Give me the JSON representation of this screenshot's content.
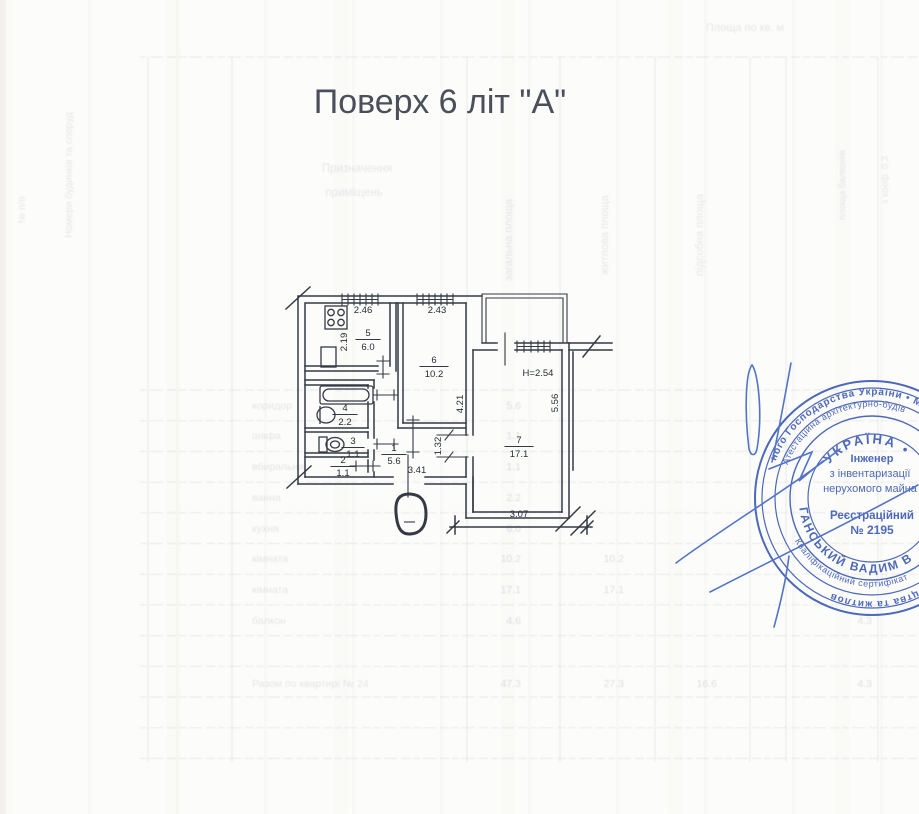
{
  "page": {
    "title": "Поверх 6 літ \"А\""
  },
  "plan": {
    "rooms": [
      {
        "num": "5",
        "area": "6.0"
      },
      {
        "num": "6",
        "area": "10.2"
      },
      {
        "num": "4",
        "area": "2.2"
      },
      {
        "num": "3",
        "area": "1.1"
      },
      {
        "num": "2",
        "area": "1.1"
      },
      {
        "num": "1",
        "area": "5.6"
      },
      {
        "num": "7",
        "area": "17.1"
      }
    ],
    "dims": {
      "w_kitchen": "2.46",
      "w_room6": "2.43",
      "h_kitchen": "2.19",
      "h_room6": "4.21",
      "w_hall": "3.41",
      "w_door7": "1.32",
      "h_room7": "5.56",
      "w_room7": "3.07",
      "ceiling": "Н=2.54"
    },
    "colors": {
      "ink": "#343944"
    }
  },
  "stamp": {
    "outer_top": "ного Господарства України  •  Міністе",
    "outer_bottom": "вництва та житлов",
    "ring2_top": "Атестаційна архітектурно-будів",
    "ring2_bottom": "Кваліфікаційний сертифікат",
    "name_arc": "ГАНСЬКИЙ  ВАДИМ  В",
    "country": "УКРАЇНА •",
    "line1": "Інженер",
    "line2": "з інвентаризації",
    "line3": "нерухомого майна",
    "line4": "Реєстраційний",
    "line5": "№ 2195",
    "color": "#3d5cb5"
  },
  "ghost": {
    "header_top": "Площа по кв. м",
    "purpose_1": "Призначення",
    "purpose_2": "приміщень",
    "vcol_total": "загальна площа",
    "vcol_living": "житлова площа",
    "vcol_aux": "підсобна площа",
    "vcol_balc": "площа балконів",
    "vcol_coef": "з коеф. 0,3",
    "vcol_left": "Номери будинків та споруд",
    "vcol_num": "№ п/п",
    "rows": [
      {
        "name": "коридор",
        "total": "5.6"
      },
      {
        "name": "шафа",
        "total": "1.1"
      },
      {
        "name": "вбиральня",
        "total": "1.1"
      },
      {
        "name": "ванна",
        "total": "2.2"
      },
      {
        "name": "кухня",
        "total": "6.0"
      },
      {
        "name": "кімната",
        "total": "10.2",
        "living": "10.2"
      },
      {
        "name": "кімната",
        "total": "17.1",
        "living": "17.1"
      },
      {
        "name": "балкон",
        "total": "4.6",
        "balc": "4.3"
      }
    ],
    "total_row": {
      "label": "Разом по квартирі № 24",
      "total": "47.3",
      "living": "27.3",
      "aux": "16.6",
      "balc": "4.3"
    }
  }
}
